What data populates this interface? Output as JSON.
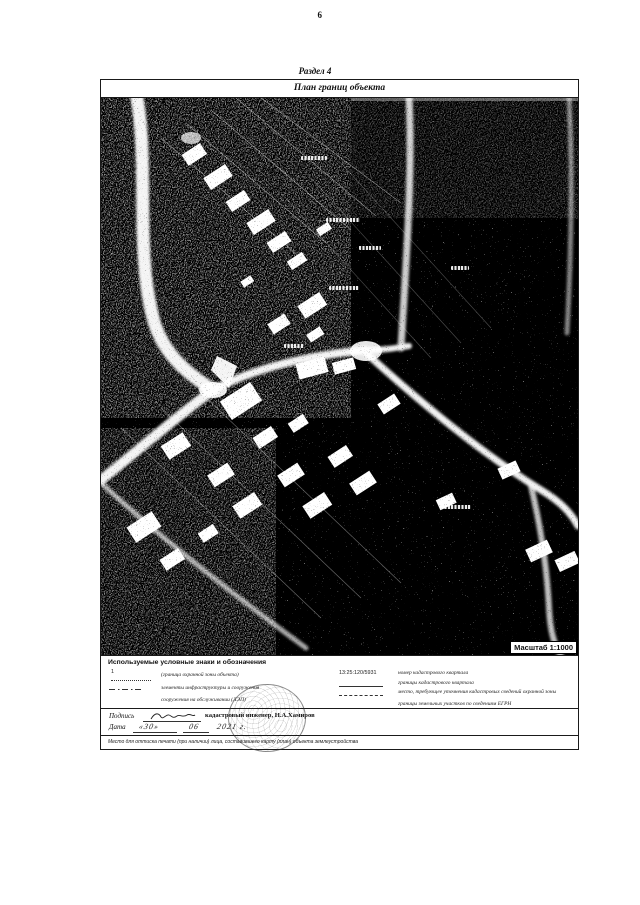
{
  "page": {
    "number": "6"
  },
  "section": {
    "label": "Раздел 4"
  },
  "plan": {
    "title": "План границ объекта",
    "scale_label": "Масштаб 1:1000"
  },
  "legend": {
    "header": "Используемые условные знаки и обозначения",
    "left": [
      {
        "symbol": "1",
        "text": "(граница охранной зоны объекта)"
      },
      {
        "symbol": "",
        "text": "элементы инфраструктуры и сооружения"
      },
      {
        "symbol": "",
        "text": "сооружения на обслуживании (ЛЭП)"
      }
    ],
    "right": [
      {
        "symbol": "13:25:120/5931",
        "text": "номер кадастрового квартала"
      },
      {
        "symbol": "",
        "text": "границы кадастрового квартала"
      },
      {
        "symbol": "",
        "text": "место, требующее уточнения кадастровых сведений охранной зоны"
      },
      {
        "symbol": "",
        "text": "границы земельных участков по сведениям ЕГРН"
      }
    ]
  },
  "signature": {
    "podpis_label": "Подпись",
    "engineer": "кадастровый инженер, Н.А.Хамиров",
    "date_label": "Дата",
    "date_day": "«30»",
    "date_month": "06",
    "date_year": "2021 г."
  },
  "footer_note": "Место для оттиска печати (при наличии) лица, составившего карту (план) объекта землеустройства"
}
